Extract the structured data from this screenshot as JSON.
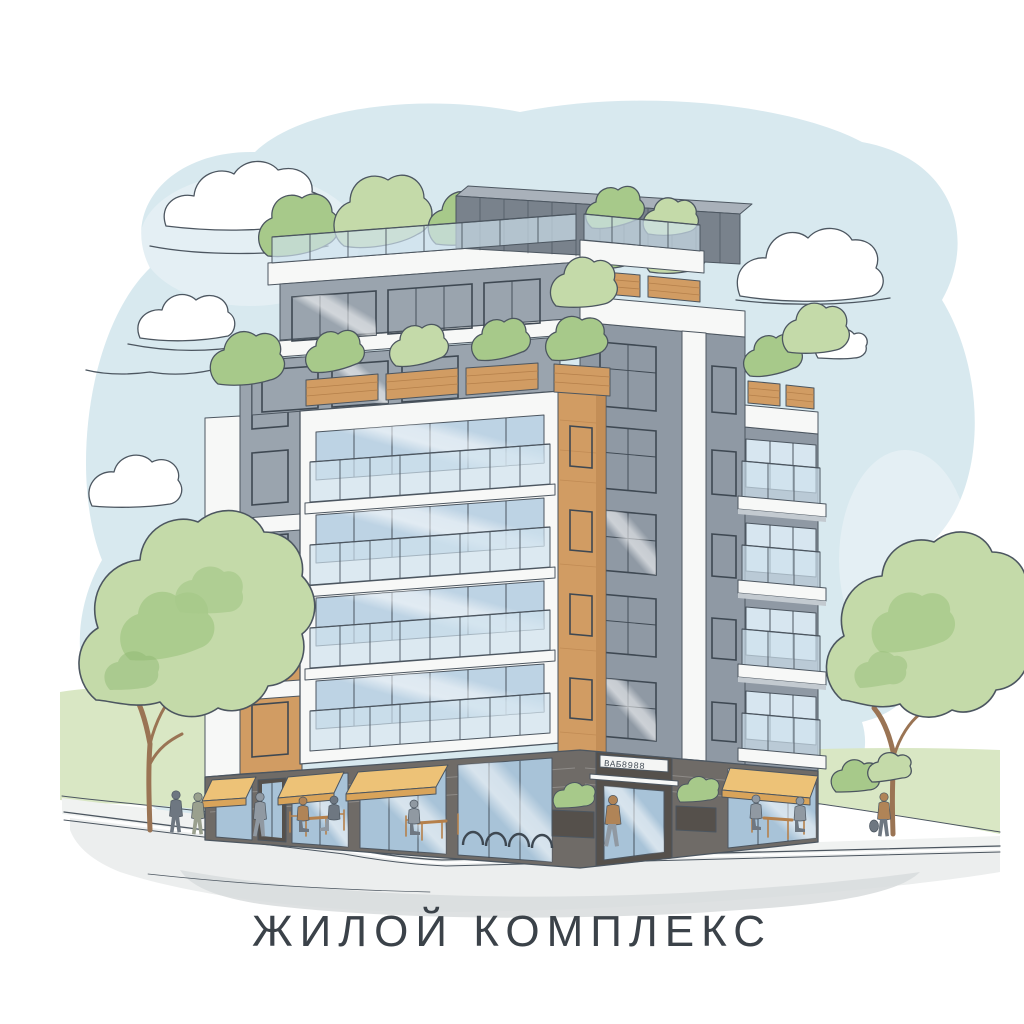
{
  "caption": {
    "text": "ЖИЛОЙ КОМПЛЕКС"
  },
  "entrance_sign": {
    "text": "ВАБ8988"
  },
  "scene": {
    "style": "watercolor architectural sketch",
    "subject": "modern residential apartment building on a street corner",
    "clouds": 6,
    "trees": 2,
    "people": 10,
    "building": {
      "floors_above_ground": 7,
      "roof_terraces": true,
      "awnings": 4,
      "bike_rack_hoops": 4,
      "entrance_planters": 2,
      "cafe_tables": 3
    }
  },
  "palette": {
    "paper": "#ffffff",
    "sky": "#d8e9ef",
    "cloud": "#ffffff",
    "outline": "#4c5660",
    "grass": "#d9e7c4",
    "walk": "#f0f2f1",
    "road": "#eceeee",
    "road_shadow": "#d8dcdd",
    "foliage_light": "#c4daa9",
    "foliage_mid": "#a7c98a",
    "foliage_dark": "#8cb66e",
    "trunk": "#9a7454",
    "gray": "#9aa4ae",
    "gray2": "#8f99a4",
    "pent": "#79828c",
    "pent_top": "#a9b1ba",
    "white_trim": "#f7f8f7",
    "slab_shade": "#c3cad0",
    "glass": "#bdd3e4",
    "glass_light": "#d7e6f0",
    "store": "#a8c3d8",
    "balu": "#cfe2ee",
    "frame": "#3e4852",
    "wood": "#d19c63",
    "wood_dark": "#b5804b",
    "base": "#6f6b67",
    "door_dark": "#55504b",
    "awning": "#edc277",
    "awning_dark": "#d9a45a",
    "sign_bg": "#f4f5f4",
    "fig_gray": "#9099a2",
    "fig_dark": "#6e7781",
    "fig_brown": "#b08457",
    "fig_olive": "#9aa08e",
    "caption": "#3b4249"
  }
}
